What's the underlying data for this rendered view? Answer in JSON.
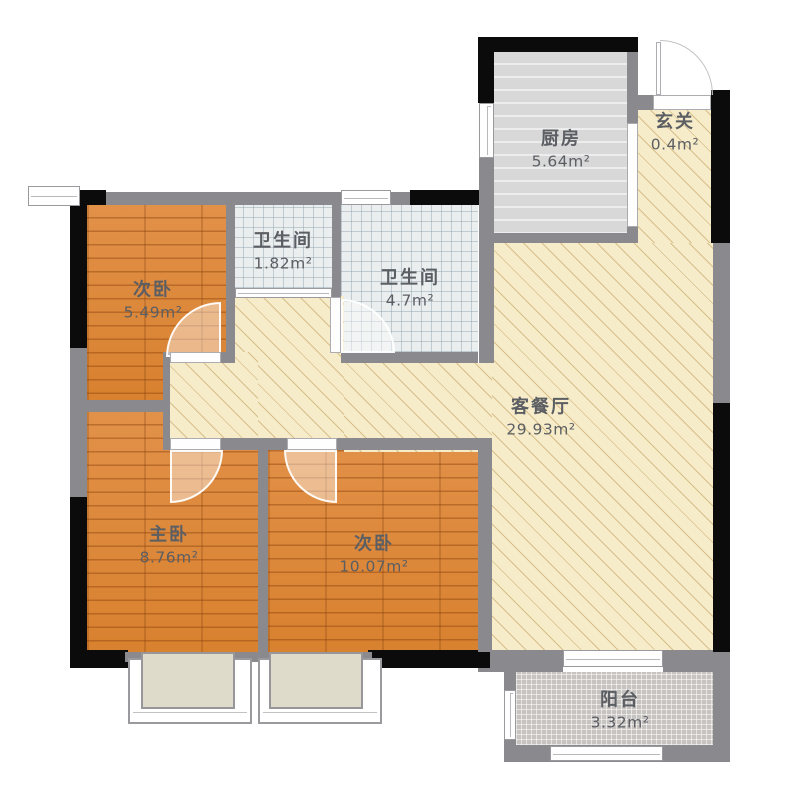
{
  "plan_title": "apartment-floor-plan",
  "rooms": [
    {
      "id": "bedroom-top",
      "name": "次卧",
      "area": "5.49m²"
    },
    {
      "id": "bathroom-small",
      "name": "卫生间",
      "area": "1.82m²"
    },
    {
      "id": "bathroom-large",
      "name": "卫生间",
      "area": "4.7m²"
    },
    {
      "id": "kitchen",
      "name": "厨房",
      "area": "5.64m²"
    },
    {
      "id": "entry",
      "name": "玄关",
      "area": "0.4m²"
    },
    {
      "id": "living-dining",
      "name": "客餐厅",
      "area": "29.93m²"
    },
    {
      "id": "master-bedroom",
      "name": "主卧",
      "area": "8.76m²"
    },
    {
      "id": "bedroom-2",
      "name": "次卧",
      "area": "10.07m²"
    },
    {
      "id": "balcony",
      "name": "阳台",
      "area": "3.32m²"
    }
  ],
  "colors": {
    "wood_floor": "#DE8A3C",
    "living_floor": "#F6ECC9",
    "bathroom_tile": "#EAEEEE",
    "kitchen_floor": "#DADADA",
    "balcony_tile": "#C7C3C0",
    "wall_gray": "#8A8A8E",
    "wall_black": "#0B0B0B",
    "window_sill": "#DFDBCA",
    "label_text": "#5B5E63"
  }
}
